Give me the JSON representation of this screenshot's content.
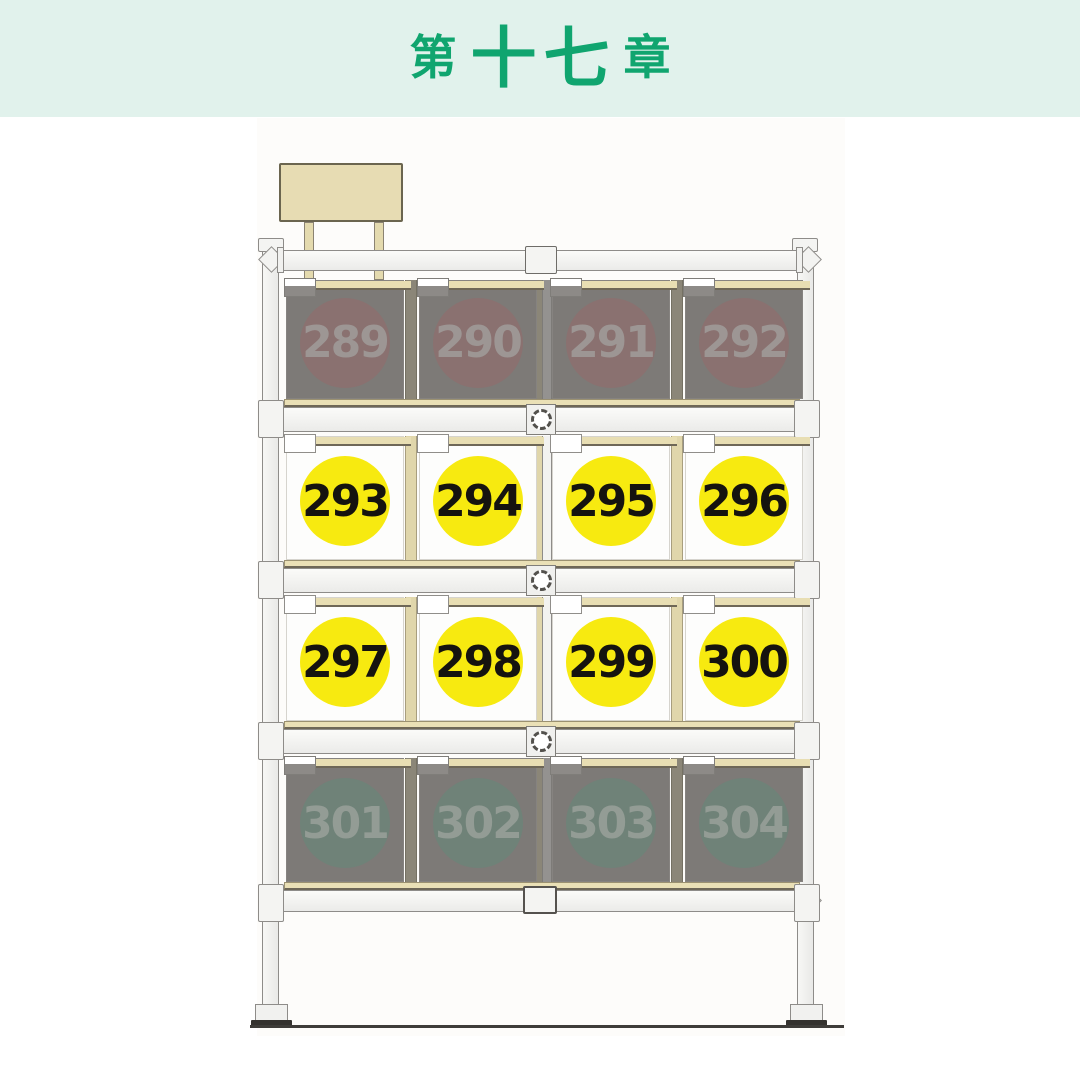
{
  "palette": {
    "mint": "#e1f2ec",
    "green": "#10a56f",
    "tan": "#e8deb3",
    "yellow": "#f7ea10",
    "maroon": "#8a7170",
    "sage": "#6f8278",
    "dark-box": "#7d7a77",
    "frame": "#f3f3f1",
    "frame-border": "#8e8c89",
    "number-text": "#15130f",
    "dim-red-text": "#9d9694",
    "dim-green-text": "#939c95"
  },
  "header": {
    "title": "第十七章",
    "title_parts": {
      "prefix": "第",
      "number": "十七",
      "suffix": "章"
    }
  },
  "shelf": {
    "rows": [
      {
        "state": "inactive",
        "tone": "maroon",
        "boxes": [
          {
            "number": "289"
          },
          {
            "number": "290"
          },
          {
            "number": "291"
          },
          {
            "number": "292"
          }
        ]
      },
      {
        "state": "active",
        "tone": "yellow",
        "boxes": [
          {
            "number": "293"
          },
          {
            "number": "294"
          },
          {
            "number": "295"
          },
          {
            "number": "296"
          }
        ]
      },
      {
        "state": "active",
        "tone": "yellow",
        "boxes": [
          {
            "number": "297"
          },
          {
            "number": "298"
          },
          {
            "number": "299"
          },
          {
            "number": "300"
          }
        ]
      },
      {
        "state": "inactive",
        "tone": "sage",
        "boxes": [
          {
            "number": "301"
          },
          {
            "number": "302"
          },
          {
            "number": "303"
          },
          {
            "number": "304"
          }
        ]
      }
    ]
  }
}
